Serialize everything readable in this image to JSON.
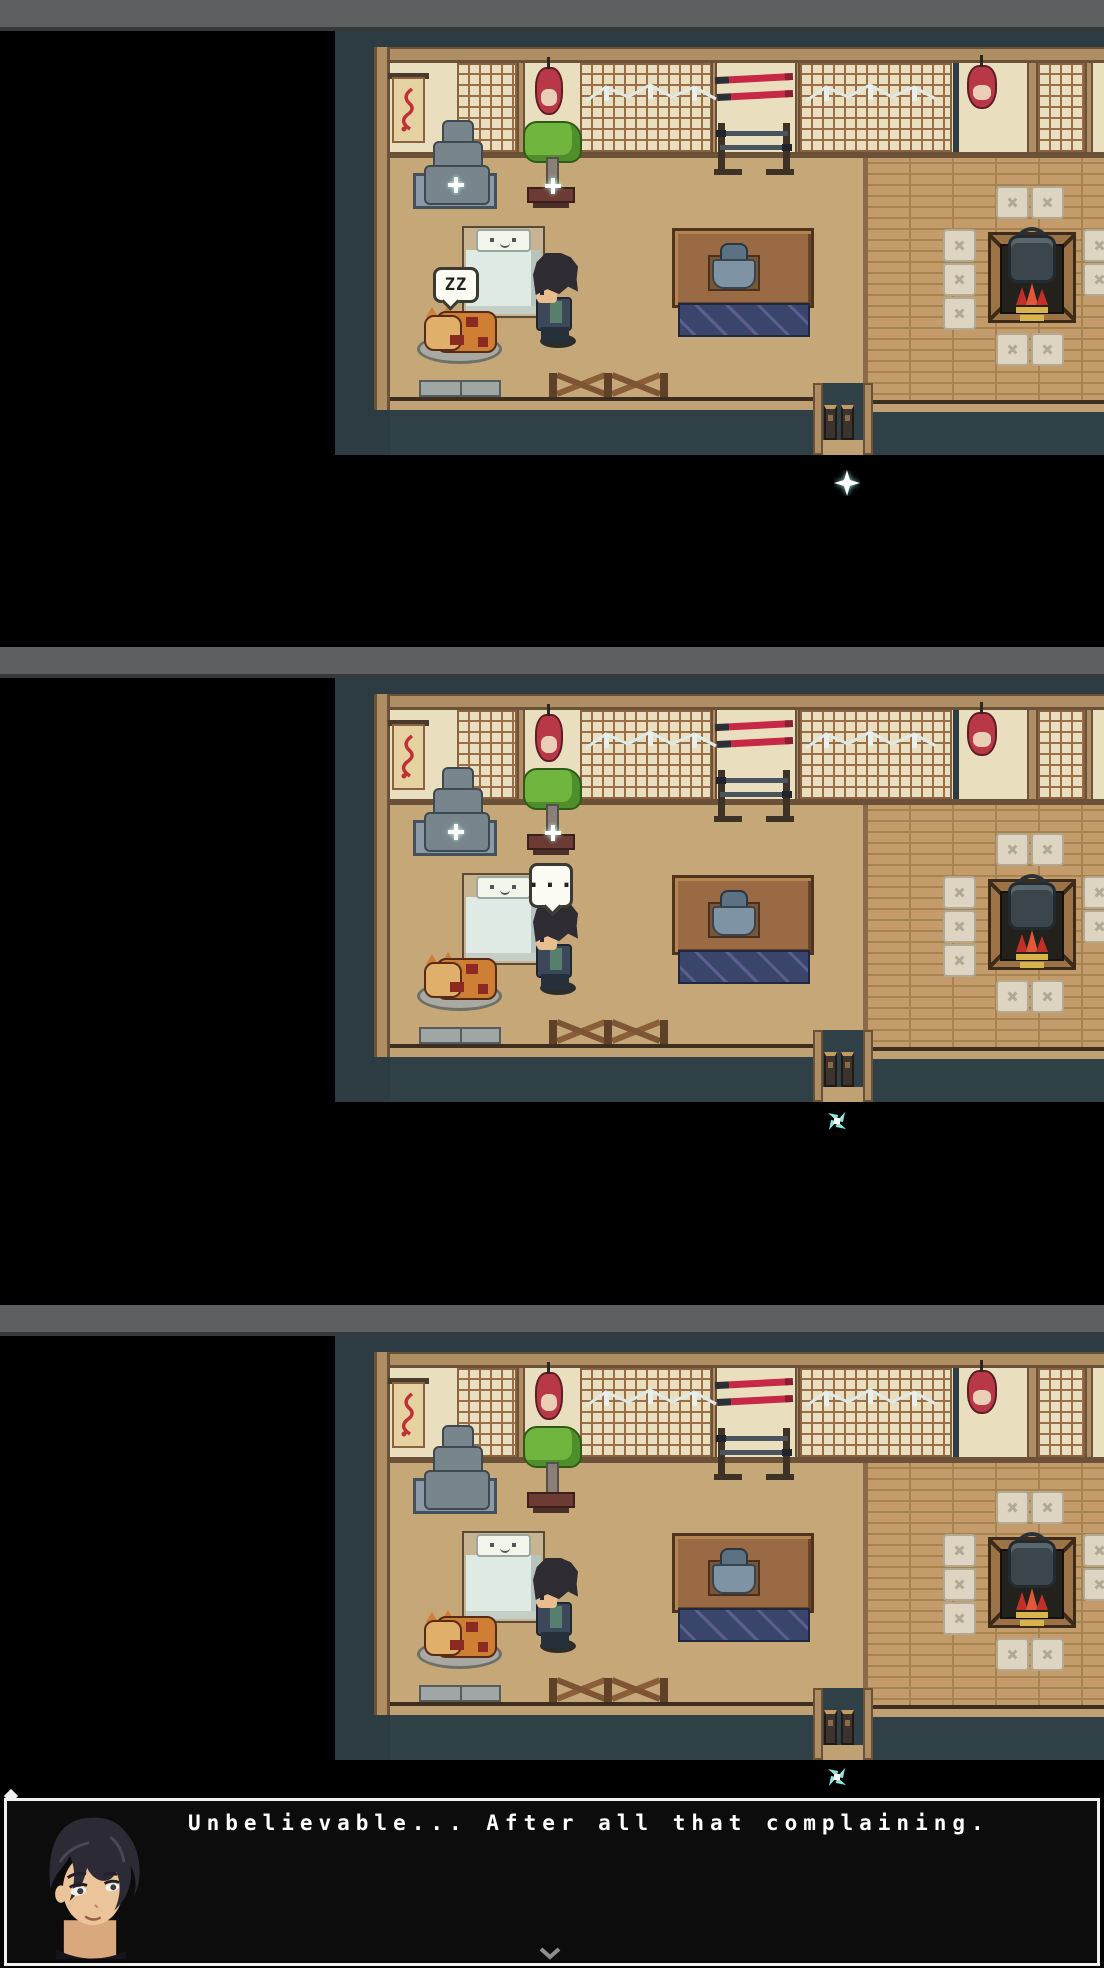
{
  "window": {
    "titlebar_color": "#5d6061"
  },
  "colors": {
    "bar": "#5d6061",
    "baredge": "#35393b",
    "teal": "#2d3c43",
    "navy": "#2f4046",
    "cream": "#e9dfbe",
    "lat": "#9a6f47",
    "beam": "#ae8e62",
    "beamdark": "#6b5138",
    "floorL": "#c6a878",
    "floorR": "#c49c6b",
    "plank": "#a6844e",
    "bed": "#e0eae4",
    "bedframe": "#c9b491",
    "tbl": "#9a6a44",
    "cloth": "#39456b",
    "stone": "#78858c",
    "slate": "#8c9aa8",
    "green": "#6fb53e",
    "pot": "#6b3b34",
    "lanred": "#b83848",
    "blade": "#c62846",
    "cush": "#ddd5c2",
    "cushedge": "#b3a992",
    "wood": "#9c7347",
    "fire": "#c13028",
    "gold": "#d8b44c",
    "orange": "#cf7f33",
    "darkred": "#8a2a22",
    "matg": "#a8aaa2",
    "hair": "#2f2b33",
    "skin": "#e9bd8d",
    "navyc": "#3c4859",
    "sash": "#57806c",
    "sparkle": "#8ee6e2"
  },
  "frames": [
    {
      "name": "game-frame-1",
      "bubble": {
        "style": "zz",
        "text": "ZZ"
      },
      "cursor": "star",
      "scene_sparkles": true
    },
    {
      "name": "game-frame-2",
      "bubble": {
        "style": "dots",
        "text": "..."
      },
      "cursor": "pinwheel",
      "scene_sparkles": true
    },
    {
      "name": "game-frame-3",
      "bubble": null,
      "cursor": "pinwheel",
      "scene_sparkles": false
    }
  ],
  "icons": {
    "cursor_star": "star-cursor-icon",
    "cursor_pinwheel": "pinwheel-cursor-icon",
    "sparkle": "sparkle-plus-icon",
    "continue": "chevron-down-icon"
  },
  "dialogue": {
    "text": "Unbelievable... After all that complaining.",
    "portrait": "dark-haired-young-man"
  }
}
